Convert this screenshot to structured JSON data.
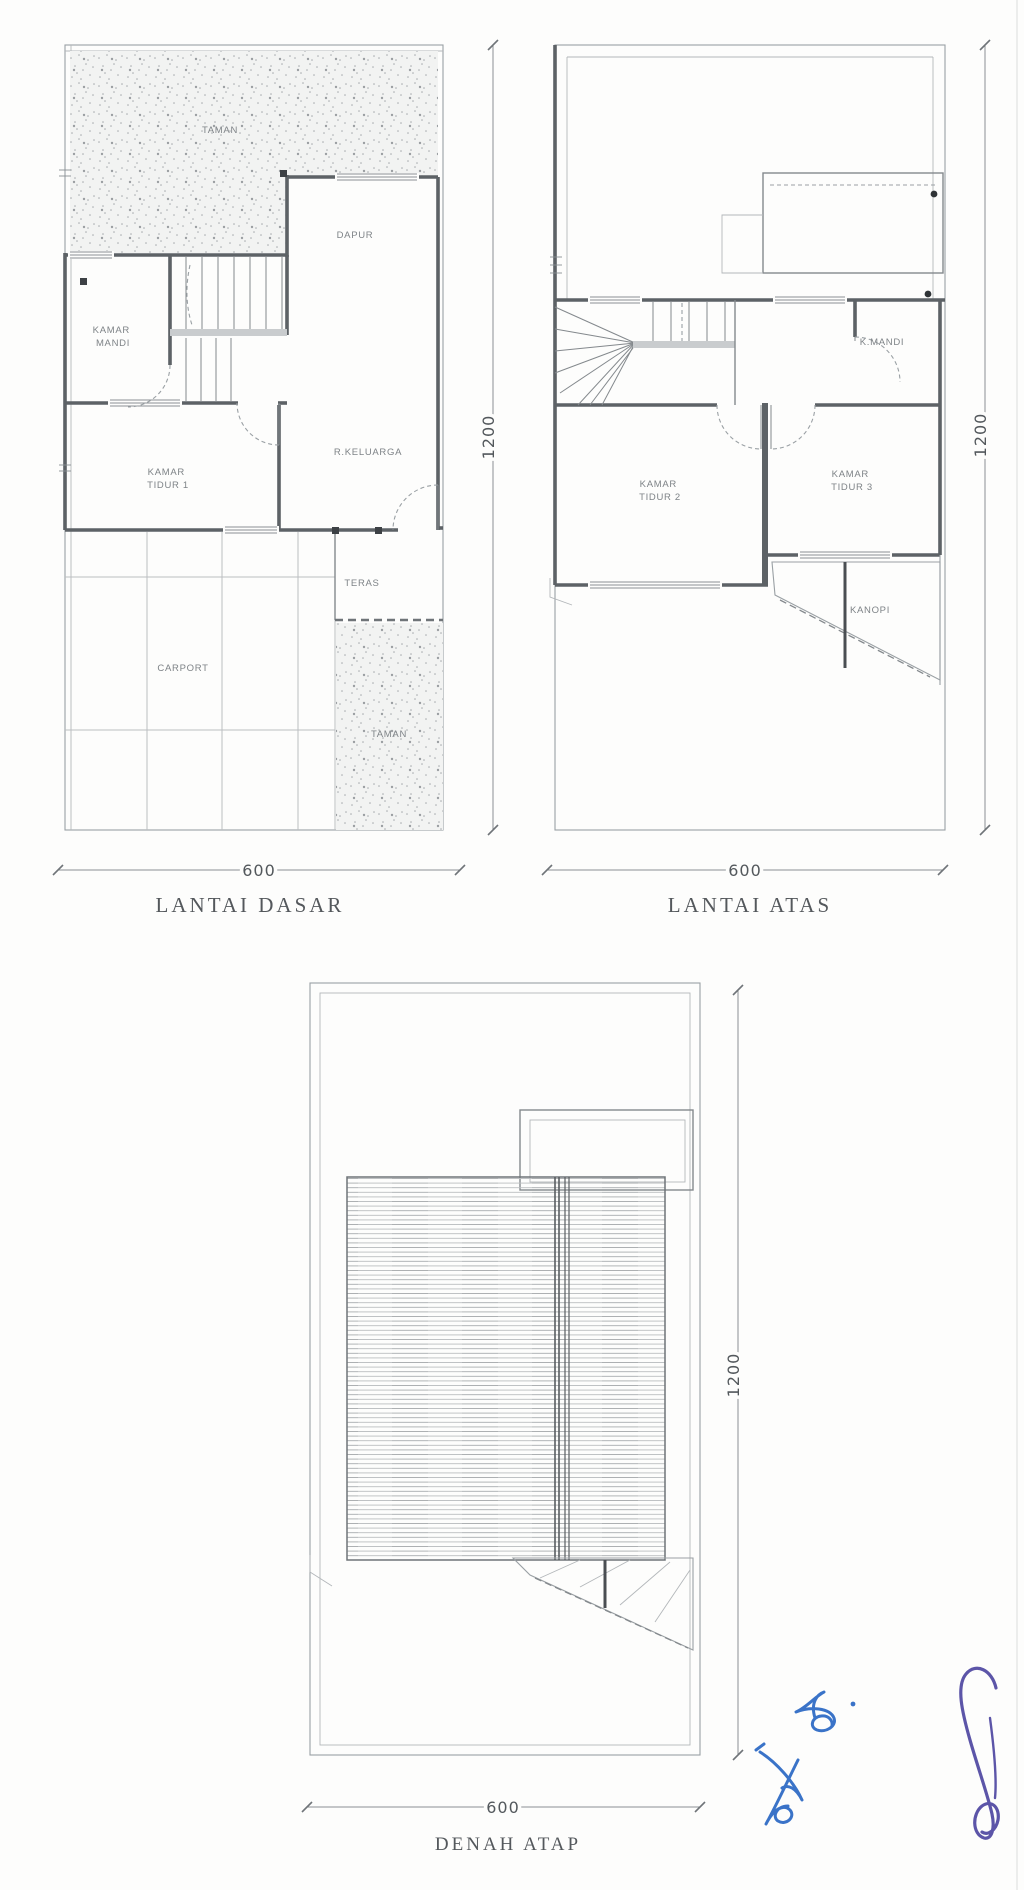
{
  "document": {
    "kind": "architectural floor plan drawing",
    "sheet_background": "#fdfdfc"
  },
  "plans": [
    {
      "id": "lantai-dasar",
      "title": "LANTAI DASAR",
      "dim_width": "600",
      "dim_height": "1200",
      "rooms": [
        {
          "name": "taman-top",
          "lines": [
            "TAMAN"
          ]
        },
        {
          "name": "dapur",
          "lines": [
            "DAPUR"
          ]
        },
        {
          "name": "kamar-mandi",
          "lines": [
            "KAMAR",
            "MANDI"
          ]
        },
        {
          "name": "kamar-tidur-1",
          "lines": [
            "KAMAR",
            "TIDUR 1"
          ]
        },
        {
          "name": "r-keluarga",
          "lines": [
            "R.KELUARGA"
          ]
        },
        {
          "name": "teras",
          "lines": [
            "TERAS"
          ]
        },
        {
          "name": "carport",
          "lines": [
            "CARPORT"
          ]
        },
        {
          "name": "taman-bottom",
          "lines": [
            "TAMAN"
          ]
        }
      ]
    },
    {
      "id": "lantai-atas",
      "title": "LANTAI ATAS",
      "dim_width": "600",
      "dim_height": "1200",
      "rooms": [
        {
          "name": "k-mandi",
          "lines": [
            "K.MANDI"
          ]
        },
        {
          "name": "kamar-tidur-2",
          "lines": [
            "KAMAR",
            "TIDUR 2"
          ]
        },
        {
          "name": "kamar-tidur-3",
          "lines": [
            "KAMAR",
            "TIDUR 3"
          ]
        },
        {
          "name": "kanopi",
          "lines": [
            "KANOPI"
          ]
        }
      ]
    },
    {
      "id": "denah-atap",
      "title": "DENAH ATAP",
      "dim_width": "600",
      "dim_height": "1200",
      "rooms": []
    }
  ],
  "colors": {
    "line": "#8a8f93",
    "wall": "#5d6266",
    "label_text": "#7e8387",
    "title_text": "#54585c",
    "signature_blue": "#3a73c8",
    "signature_purple": "#5c55a8"
  }
}
